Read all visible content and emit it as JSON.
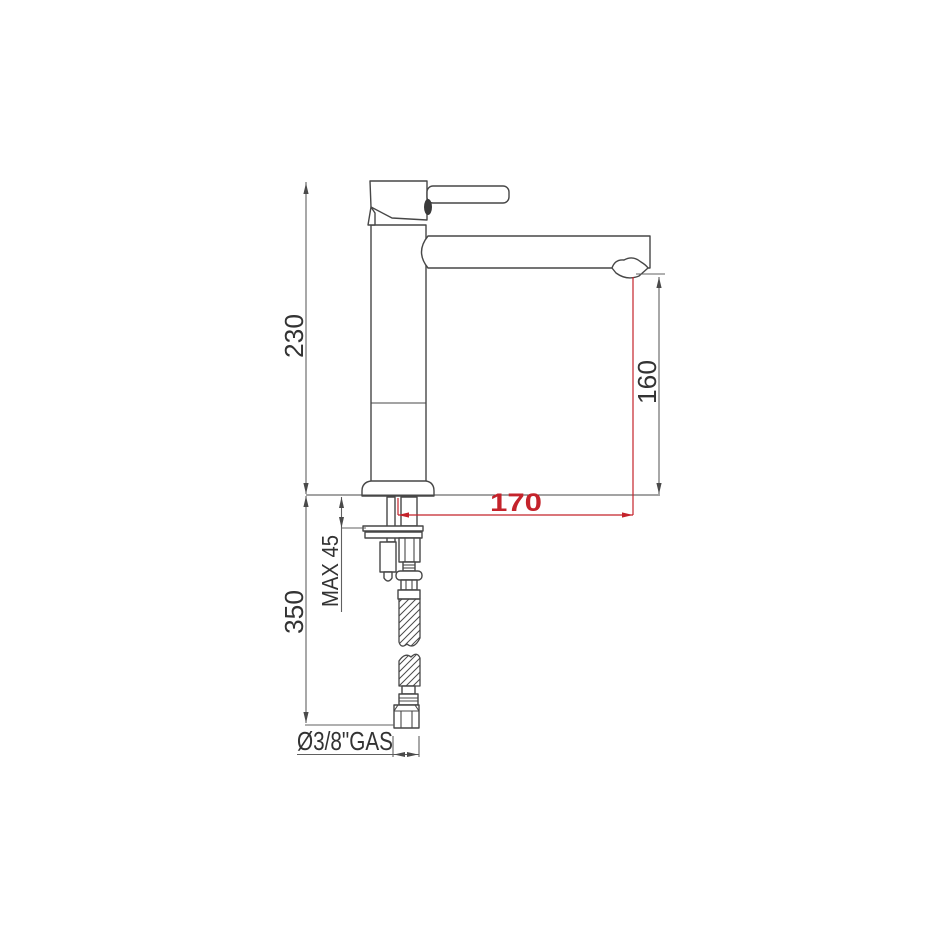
{
  "diagram": {
    "title": "single-lever-tall-basin-mixer-technical-drawing",
    "dimensions": {
      "total_height": {
        "label": "230"
      },
      "spout_height": {
        "label": "160"
      },
      "spout_reach": {
        "label": "170",
        "color": "#c4232b"
      },
      "under_counter_depth": {
        "label": "350"
      },
      "max_counter_thickness": {
        "label": "MAX 45"
      },
      "hose_connection": {
        "label": "Ø3/8\"GAS"
      }
    },
    "colors": {
      "outline": "#474747",
      "dimension_line": "#606060",
      "accent_red": "#c4232b",
      "background": "#ffffff"
    }
  }
}
